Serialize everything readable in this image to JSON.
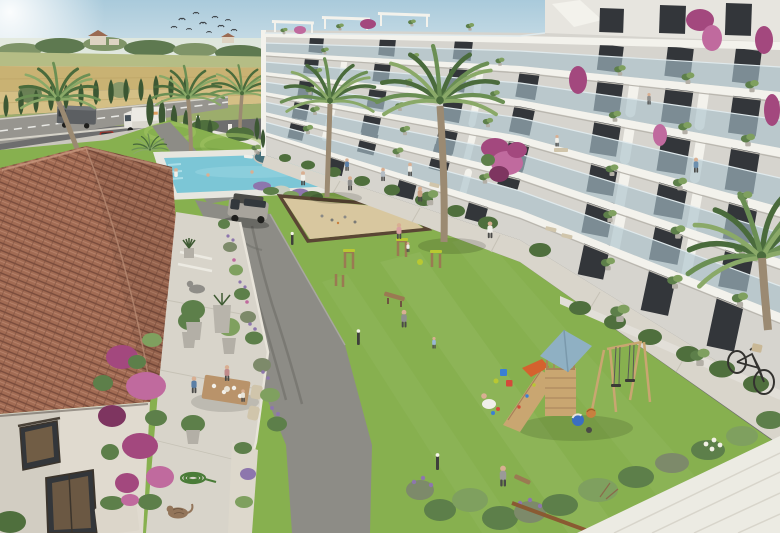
{
  "scene": {
    "kind": "architectural-rendering",
    "subject": "resort-courtyard-with-apartment-block-and-tiled-roof-house"
  },
  "inventory": {
    "birds": 10,
    "apartment_floors_visible": 5,
    "palm_trees": 8,
    "cypress_trees": 19,
    "vehicles": [
      "box-truck",
      "panel-van",
      "red-car",
      "silver-suv",
      "bicycle"
    ],
    "amenities": [
      "swimming-pool",
      "sun-loungers",
      "petanque-sand-court",
      "outdoor-gym",
      "playground-tower",
      "swing-set",
      "slide",
      "central-lawn",
      "dining-terrace",
      "garden-pond"
    ],
    "animals": [
      "cat"
    ],
    "flora": [
      "bougainvillea",
      "lavender",
      "olive-pots",
      "hedges",
      "wheat-fields"
    ]
  },
  "palette": {
    "sky_top": "#a9cadb",
    "sky_horizon": "#e4edf0",
    "haze": "#e3e9dc",
    "treeline": "#7f9468",
    "treeline_dark": "#5e7950",
    "farm_wall": "#ddd3c2",
    "farm_roof": "#9a6a52",
    "field_green": "#b5bd85",
    "field_gold": "#c9b273",
    "field_wheat": "#d4bf85",
    "verge": "#9cad6c",
    "road": "#97958f",
    "road_line": "#e9e9e5",
    "guardrail": "#d5d2c8",
    "cypress": "#3c5733",
    "hedge": "#4f6f3d",
    "lawn": "#87b04f",
    "lawn_light": "#a2c464",
    "lawn_dark": "#6f9a3f",
    "pond": "#47707a",
    "pool_deck": "#e7e6df",
    "pool_water": "#7cc6d6",
    "pool_water_light": "#aadee8",
    "sand": "#d8c79f",
    "sand_border": "#5a4634",
    "asphalt": "#8d8c86",
    "sidewalk": "#cac7be",
    "promenade": "#d9d5cb",
    "walkway": "#ecebe3",
    "roof_tile": "#a26b53",
    "roof_tile_dark": "#7a4c3c",
    "roof_tile_light": "#c4937a",
    "house_wall": "#e0dacf",
    "window_dark": "#33363a",
    "window_glow": "#b08350",
    "terrace_stone": "#d8d4ca",
    "stone_trim": "#e8e4da",
    "apt_wall": "#e7e5df",
    "apt_fascia": "#f3f2ec",
    "apt_band": "#d6d4ce",
    "apt_shade": "#c9c6bf",
    "glass": "#a9c2cc",
    "glass_edge": "#dfe9ec",
    "foliage": "#5d7f4a",
    "foliage_light": "#7fa05f",
    "bougainvillea": "#a3487e",
    "bougainvillea_light": "#c06a9e",
    "lavender": "#8d76ad",
    "lavender_leaf": "#7d8a6a",
    "palm_dark": "#4a6b3c",
    "palm_mid": "#6b8f54",
    "palm_light": "#8aa968",
    "palm_trunk": "#9b8a72",
    "wood": "#9a7a52",
    "playset_wood": "#c9a671",
    "playset_roof": "#8fb0c3",
    "slide_orange": "#d4622e",
    "gym_yellow": "#b8c832",
    "ball_blue": "#3a6ec2",
    "ball_orange": "#c9803f",
    "bucket_blue": "#3a7fd4",
    "bucket_red": "#d44a3a",
    "suv_body": "#a8a49c",
    "suv_roof": "#4a4a46",
    "car_red": "#c23a30",
    "truck_white": "#eceae4",
    "van_gray": "#5c5f62",
    "vehicle_glass": "#33383c",
    "bike": "#33322f",
    "basket": "#c9b896",
    "hose": "#4a7c38",
    "cat": "#93755a",
    "skin": "#d9af92",
    "pants": "#4a4a48",
    "bird": "#3a3f44",
    "pot": "#b3afa6",
    "furniture": "#d0c5ab",
    "table_wood": "#b9936a"
  }
}
